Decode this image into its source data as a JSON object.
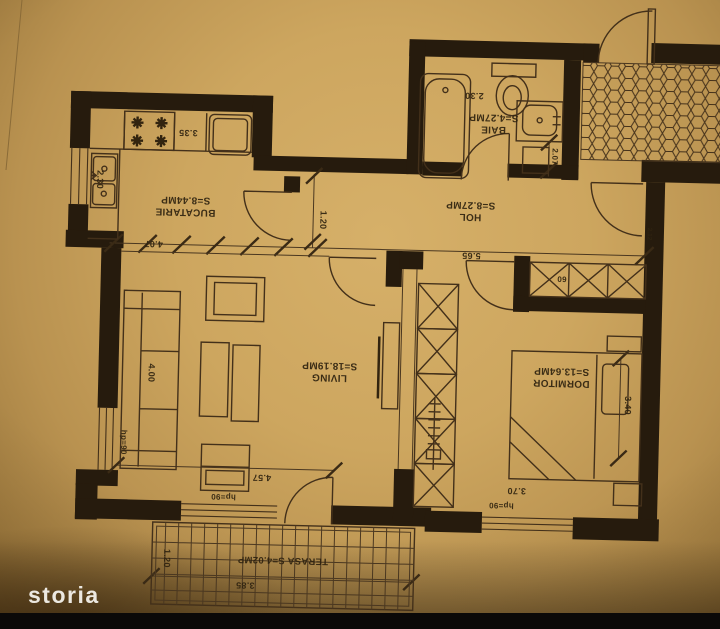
{
  "watermark": {
    "brand": "storia"
  },
  "palette": {
    "paper": "#cda65f",
    "ink": "#43301a",
    "wall": "#261b0d",
    "bottom_band": "#0b0908",
    "logo_text": "#f2efe9"
  },
  "plan_orientation": "rotated-180",
  "rooms": {
    "kitchen": {
      "name": "BUCATARIE",
      "area": "S=8.44MP"
    },
    "hall": {
      "name": "HOL",
      "area": "S=8.27MP"
    },
    "bath": {
      "name": "BAIE",
      "area": "S=4.27MP"
    },
    "living": {
      "name": "LIVING",
      "area": "S=18.19MP"
    },
    "bedroom": {
      "name": "DORMITOR",
      "area": "S=13.64MP"
    },
    "terrace": {
      "label": "TERASA S=4.02MP"
    }
  },
  "dimensions": {
    "kitchen_width": "3.35",
    "kitchen_depth": "2.30",
    "kitchen_opening": "4.07",
    "hall_width": "1.20",
    "hall_length": "5.65",
    "hall_closet": "60",
    "bath_width": "2.30",
    "bath_depth": "2.07",
    "entry": "2.12",
    "living_sofa": "4.00",
    "living_length": "4.57",
    "living_window_side": "hp=90",
    "living_window_front": "hp=90",
    "bedroom_depth": "3.40",
    "bedroom_width": "3.70",
    "bedroom_window": "hp=90",
    "terrace_depth": "1.20",
    "terrace_width": "3.85"
  }
}
